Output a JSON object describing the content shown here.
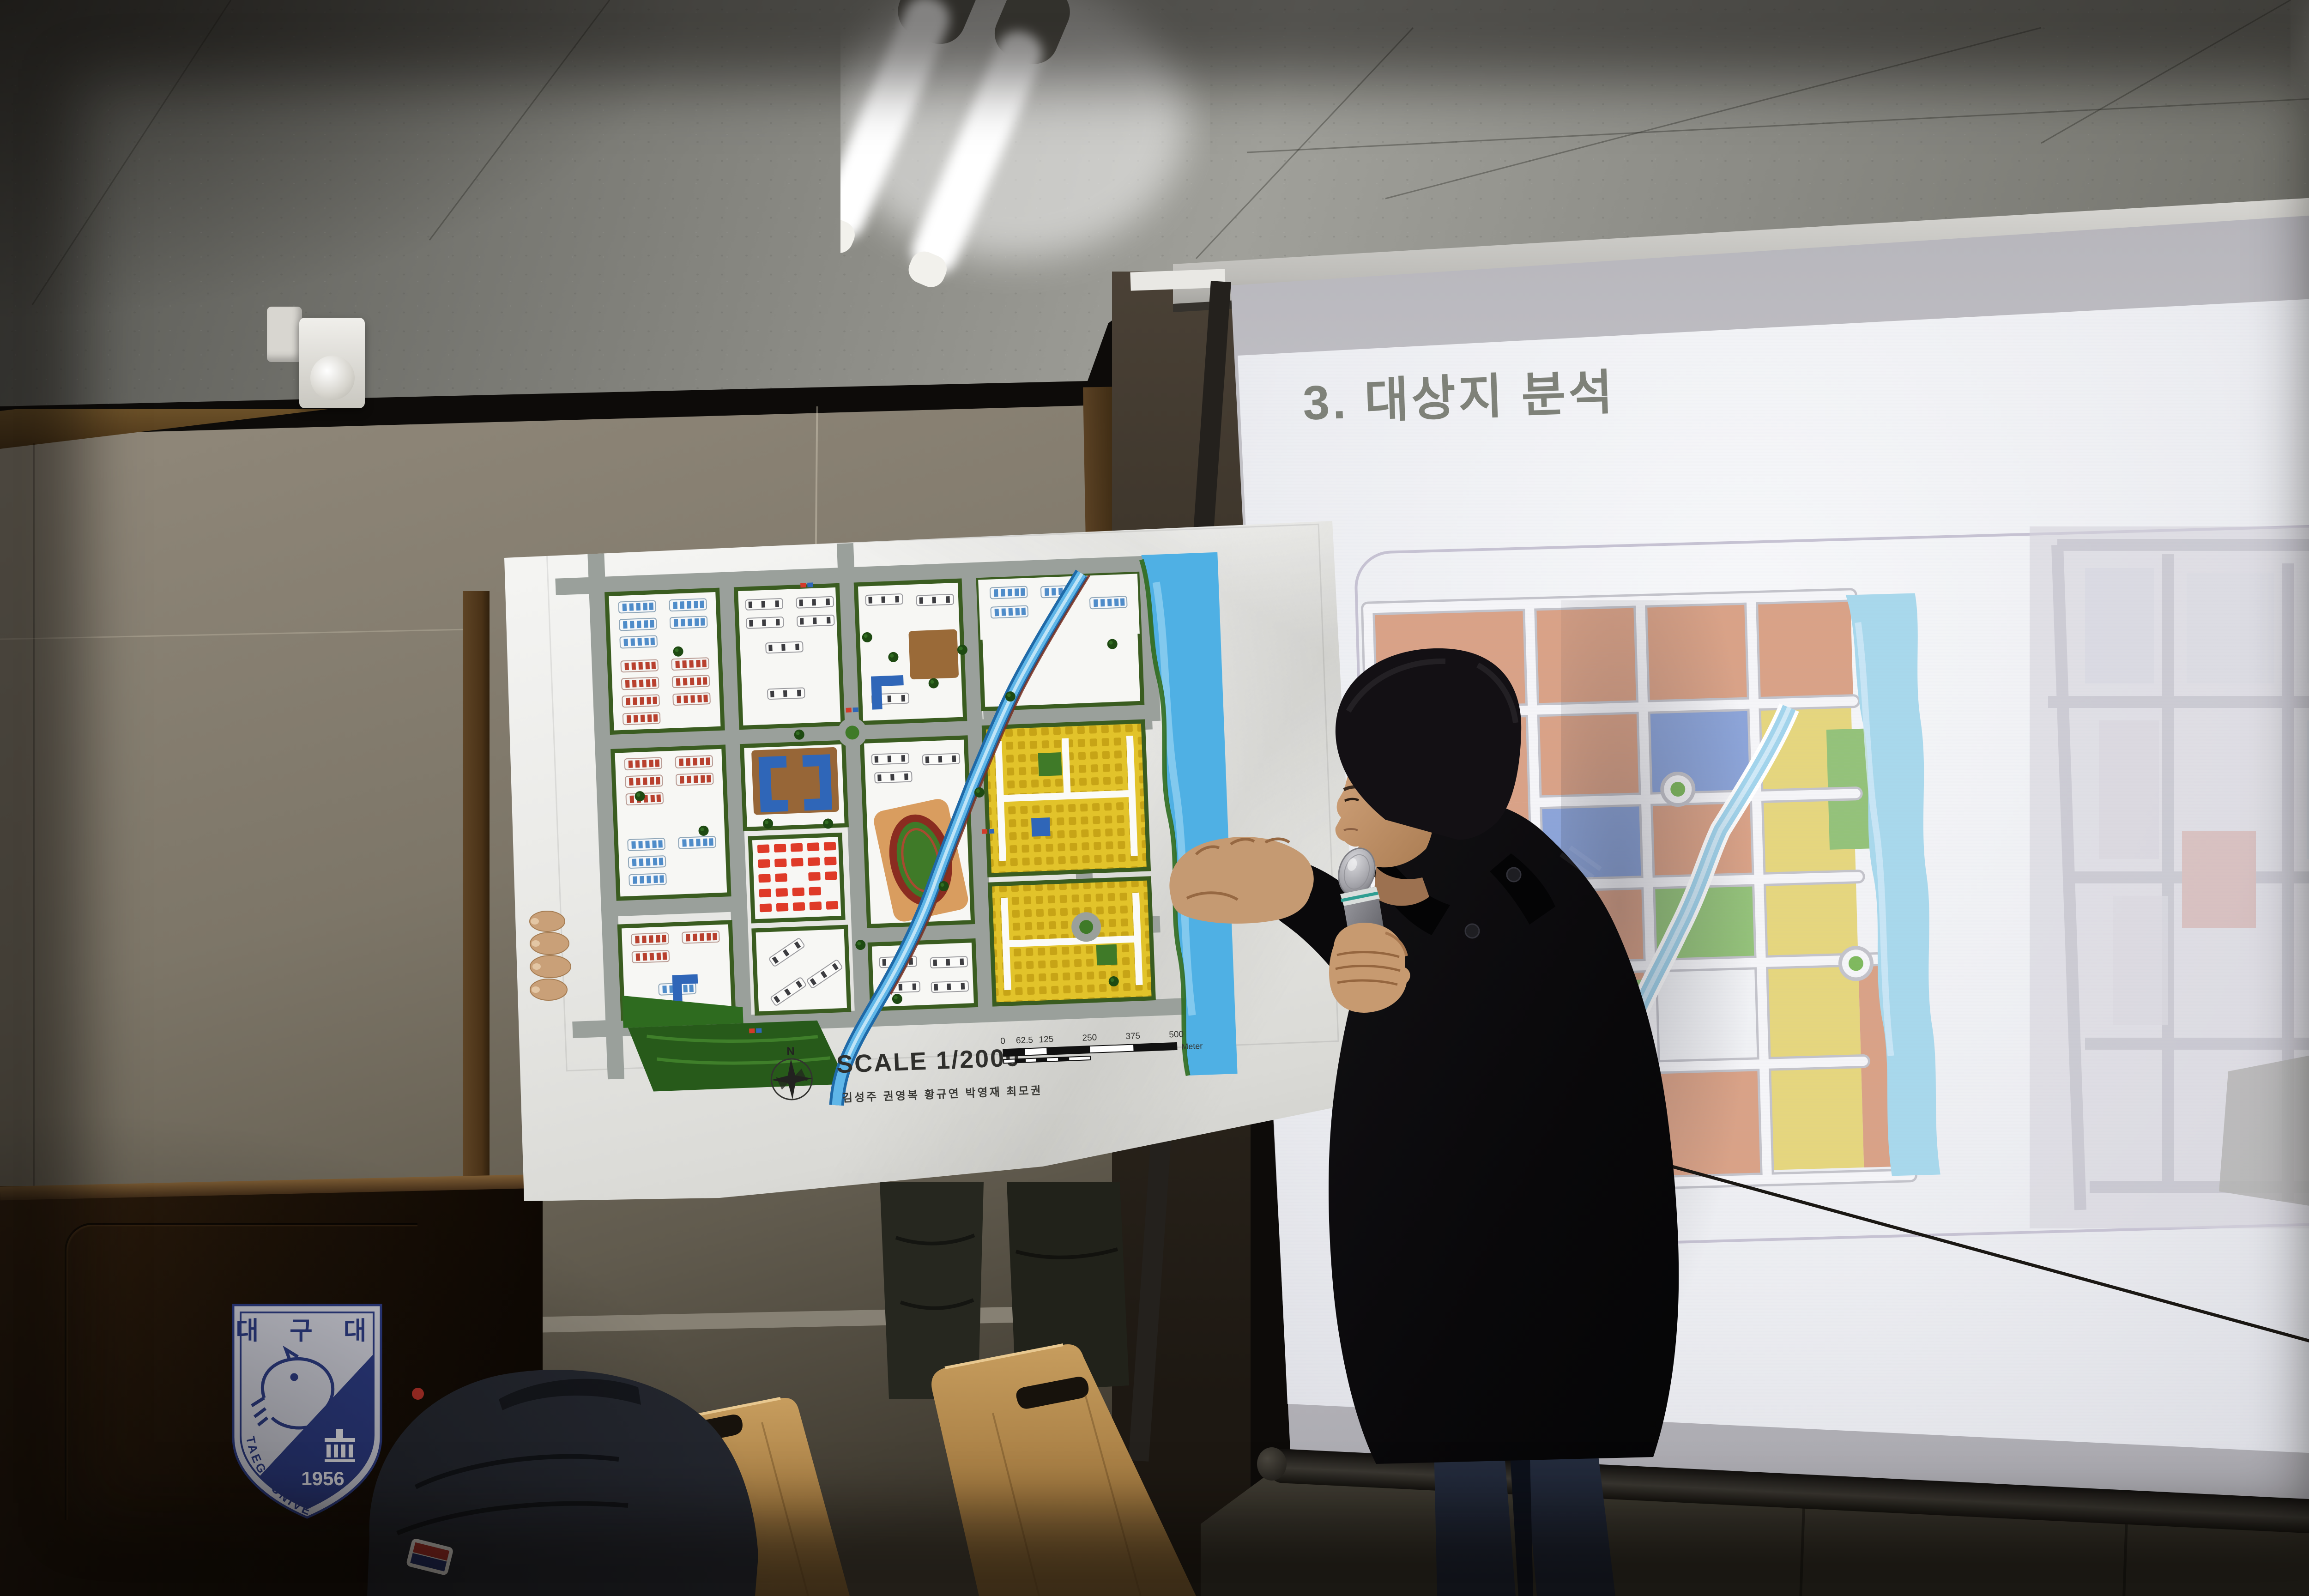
{
  "slide": {
    "title": "3. 대상지 분석"
  },
  "poster": {
    "scale_label": "SCALE 1/2000",
    "credits": "김성주  권영복  황규연  박영재  최모권",
    "compass_label": "N",
    "scalebar": {
      "labels": [
        "0",
        "62.5",
        "125",
        "250",
        "375",
        "500"
      ],
      "unit": "Meter"
    }
  },
  "podium": {
    "emblem": {
      "name": "대 구 대",
      "year": "1956",
      "arc_text": "TAEGU UNIVERSITY"
    }
  },
  "colors": {
    "zone_salmon": "#d9a287",
    "zone_blue": "#8ca4d8",
    "zone_yellow": "#e5d67e",
    "zone_green": "#94c27a",
    "river_blue": "#4fb0e4",
    "plan_yellow": "#e2c32a",
    "plan_red": "#df3a28",
    "emblem_navy": "#2b3a80"
  }
}
